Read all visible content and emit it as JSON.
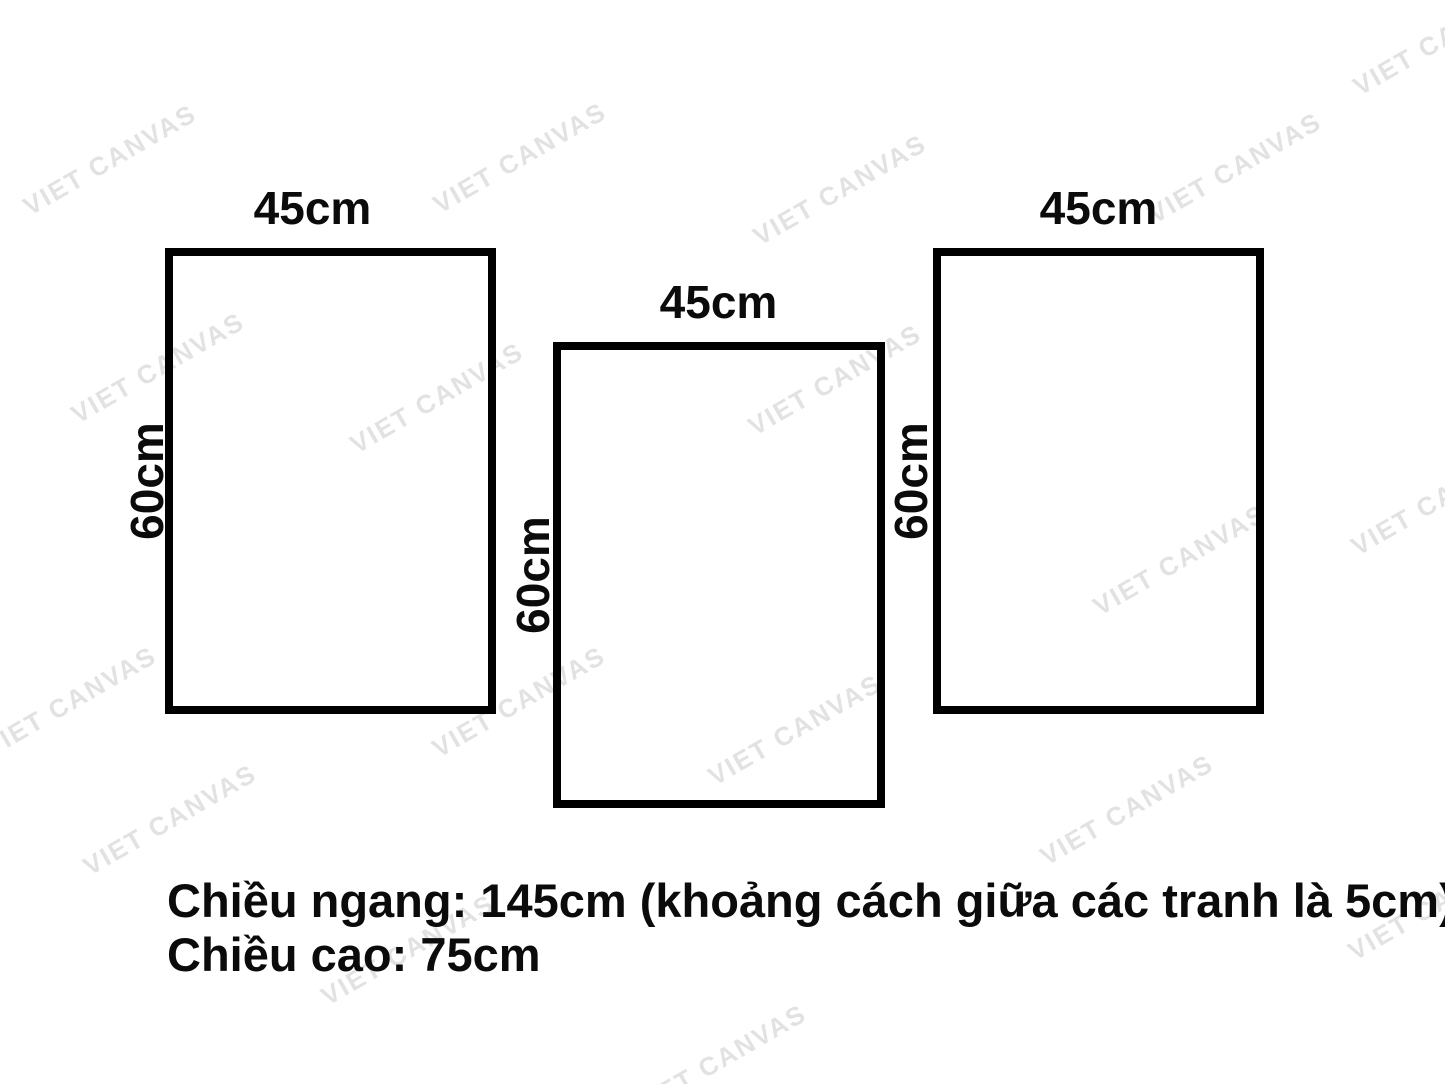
{
  "page": {
    "background_color": "#ffffff",
    "line_color": "#000000",
    "text_color": "#0b0b0b"
  },
  "panels": [
    {
      "name": "left",
      "width_label": "45cm",
      "height_label": "60cm"
    },
    {
      "name": "middle",
      "width_label": "45cm",
      "height_label": "60cm"
    },
    {
      "name": "right",
      "width_label": "45cm",
      "height_label": "60cm"
    }
  ],
  "caption": {
    "line1": "Chiều ngang: 145cm (khoảng cách giữa các tranh là 5cm)",
    "line2": "Chiều cao: 75cm"
  },
  "watermark": {
    "text": "VIET CANVAS",
    "color": "#e2e2e2",
    "angle_deg": -30,
    "instances": [
      {
        "x": 110,
        "y": 160
      },
      {
        "x": 520,
        "y": 158
      },
      {
        "x": 840,
        "y": 190
      },
      {
        "x": 1235,
        "y": 168
      },
      {
        "x": 1440,
        "y": 40
      },
      {
        "x": 158,
        "y": 368
      },
      {
        "x": 437,
        "y": 398
      },
      {
        "x": 835,
        "y": 380
      },
      {
        "x": 1180,
        "y": 560
      },
      {
        "x": 1438,
        "y": 500
      },
      {
        "x": 70,
        "y": 702
      },
      {
        "x": 519,
        "y": 702
      },
      {
        "x": 795,
        "y": 730
      },
      {
        "x": 1127,
        "y": 810
      },
      {
        "x": 170,
        "y": 820
      },
      {
        "x": 408,
        "y": 950
      },
      {
        "x": 1435,
        "y": 905
      },
      {
        "x": 720,
        "y": 1060
      }
    ]
  }
}
